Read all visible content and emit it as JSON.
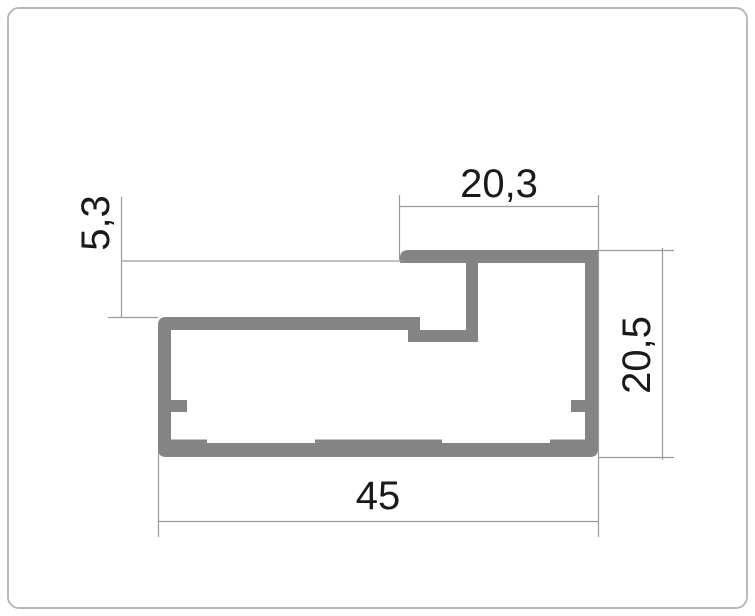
{
  "drawing": {
    "type": "profile-cross-section-dimension-drawing",
    "units_style": "comma-decimal"
  },
  "dimensions": {
    "top_width": "20,3",
    "left_depth": "5,3",
    "right_height": "20,5",
    "bottom_width": "45"
  },
  "colors": {
    "profile": "#848484",
    "dimension_line": "#9b9b9b",
    "text": "#1a1a1a",
    "card_border": "#b9b9b9",
    "card_background": "#ffffff"
  }
}
